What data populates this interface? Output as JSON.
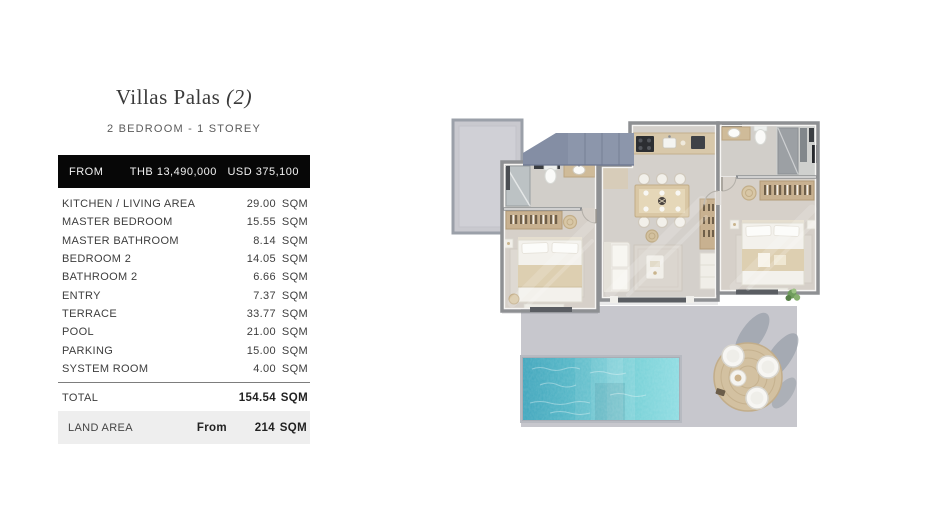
{
  "page": {
    "title": "Villas Palas",
    "title_suffix": "(2)",
    "subtitle": "2 BEDROOM - 1 STOREY"
  },
  "price_bar": {
    "label": "FROM",
    "thb": "THB 13,490,000",
    "usd": "USD 375,100"
  },
  "areas": {
    "rows": [
      {
        "label": "KITCHEN / LIVING AREA",
        "value": "29.00",
        "unit": "SQM"
      },
      {
        "label": "MASTER BEDROOM",
        "value": "15.55",
        "unit": "SQM"
      },
      {
        "label": "MASTER BATHROOM",
        "value": "8.14",
        "unit": "SQM"
      },
      {
        "label": "BEDROOM 2",
        "value": "14.05",
        "unit": "SQM"
      },
      {
        "label": "BATHROOM 2",
        "value": "6.66",
        "unit": "SQM"
      },
      {
        "label": "ENTRY",
        "value": "7.37",
        "unit": "SQM"
      },
      {
        "label": "TERRACE",
        "value": "33.77",
        "unit": "SQM"
      },
      {
        "label": "POOL",
        "value": "21.00",
        "unit": "SQM"
      },
      {
        "label": "PARKING",
        "value": "15.00",
        "unit": "SQM"
      },
      {
        "label": "SYSTEM ROOM",
        "value": "4.00",
        "unit": "SQM"
      }
    ],
    "total": {
      "label": "TOTAL",
      "value": "154.54",
      "unit": "SQM"
    },
    "land": {
      "label": "LAND AREA",
      "prefix": "From",
      "value": "214",
      "unit": "SQM"
    }
  },
  "floor_plan": {
    "regions": [
      "parking-pad",
      "carport-roof",
      "master-bathroom",
      "master-bedroom",
      "entry",
      "kitchen",
      "dining-area",
      "living-area",
      "bathroom-2",
      "bedroom-2",
      "terrace",
      "pool",
      "outdoor-dining-set"
    ],
    "colors": {
      "wall": "#8e9093",
      "floor_bath": "#d1cec9",
      "floor_bedroom": "#d6d0c9",
      "wood": "#d8c8aa",
      "wardrobe": "#c8b190",
      "terrace": "#c7c7cd",
      "pool_water_dark": "#3fa5bc",
      "pool_water_light": "#8edce2",
      "roof": "#8c96ab",
      "parking": "#c9c9cf"
    }
  }
}
